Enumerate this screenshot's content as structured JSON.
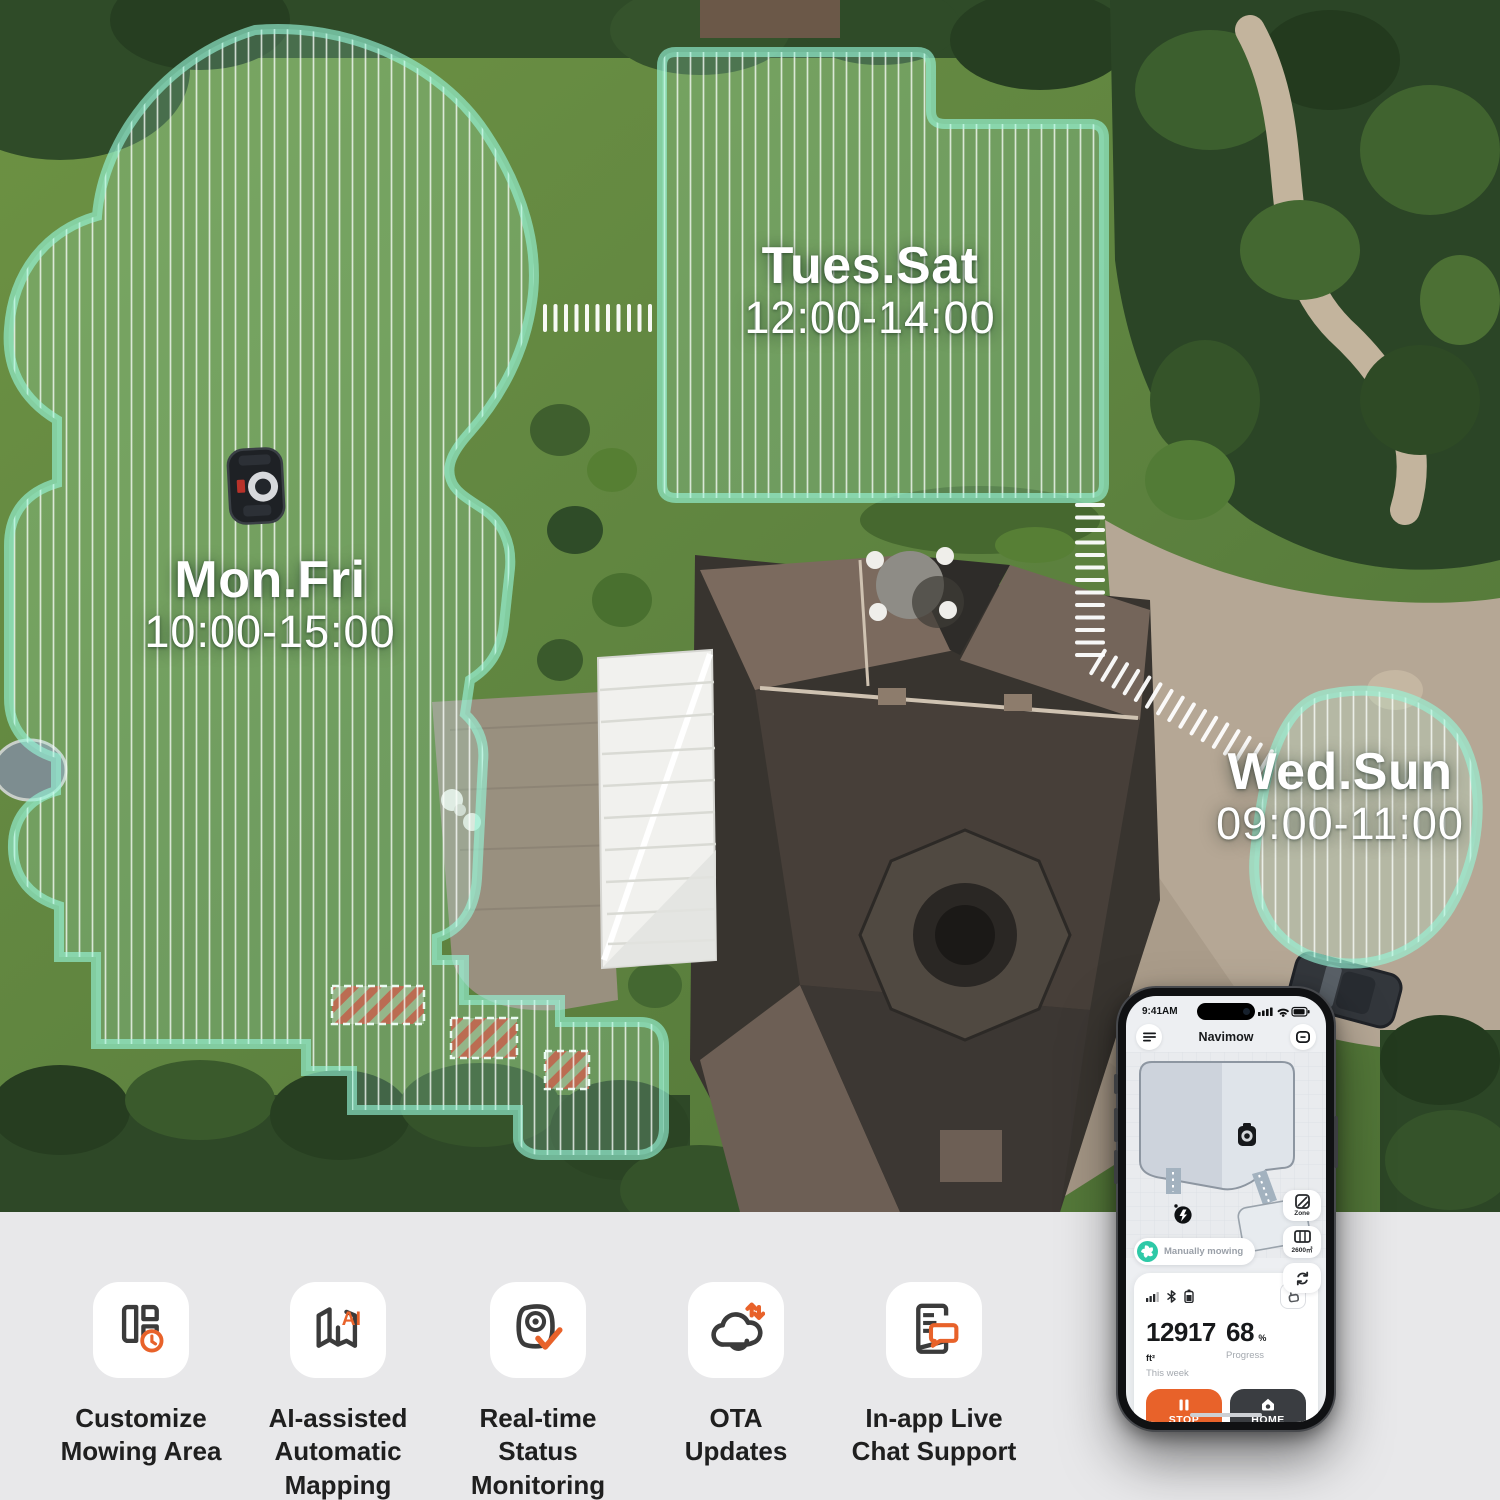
{
  "zones": {
    "mon_fri": {
      "days": "Mon.Fri",
      "time": "10:00-15:00"
    },
    "tues_sat": {
      "days": "Tues.Sat",
      "time": "12:00-14:00"
    },
    "wed_sun": {
      "days": "Wed.Sun",
      "time": "09:00-11:00"
    }
  },
  "phone": {
    "status_time": "9:41AM",
    "app_title": "Navimow",
    "map": {
      "zone_button": "Zone",
      "area_button": "2600㎡",
      "status_pill": "Manually mowing"
    },
    "stats": {
      "area_value": "12917",
      "area_unit": "ft²",
      "area_label": "This week",
      "progress_value": "68",
      "progress_unit": "%",
      "progress_label": "Progress"
    },
    "actions": {
      "stop": "STOP",
      "home": "HOME"
    }
  },
  "features": [
    {
      "name": "customize-mowing-area",
      "label": "Customize\nMowing Area"
    },
    {
      "name": "ai-assisted-automatic-mapping",
      "label": "AI-assisted\nAutomatic\nMapping"
    },
    {
      "name": "real-time-status-monitoring",
      "label": "Real-time\nStatus\nMonitoring"
    },
    {
      "name": "ota-updates",
      "label": "OTA\nUpdates"
    },
    {
      "name": "in-app-live-chat-support",
      "label": "In-app Live\nChat Support"
    }
  ],
  "icons": {
    "ai_badge": "AI"
  },
  "colors": {
    "accent_orange": "#E8622A",
    "status_green": "#2EC9A7",
    "zone_outline": "#F2FFFB",
    "home_button_dark": "#3A3D41"
  }
}
